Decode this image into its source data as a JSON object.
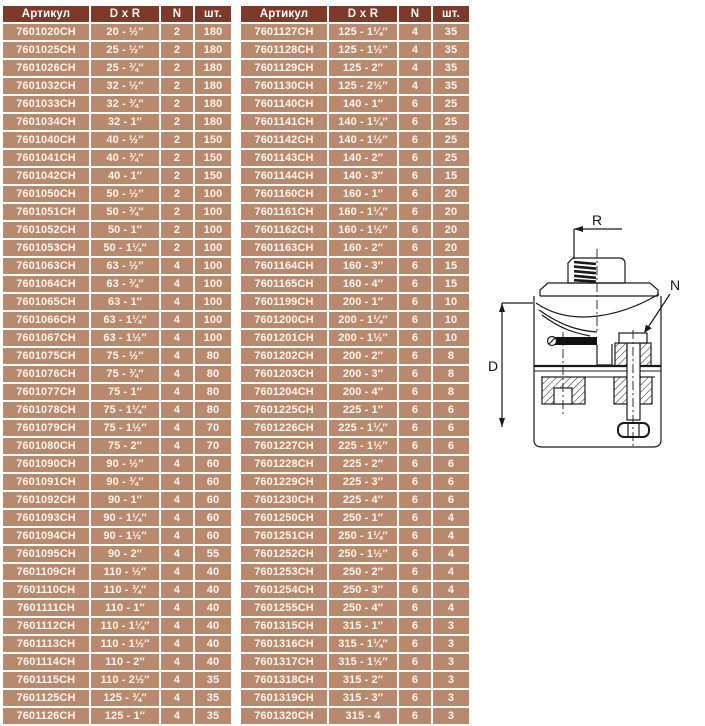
{
  "colors": {
    "header_bg": "#7e3a28",
    "row_bg": "#b9896e",
    "grid": "#ffffff",
    "header_text": "#ffffff",
    "row_text": "#fcf5ee",
    "diagram_line": "#1a1a1a"
  },
  "tables": {
    "headers": [
      "Артикул",
      "D x R",
      "N",
      "шт."
    ],
    "left": {
      "rows": [
        [
          "7601020CH",
          "20 - ½″",
          "2",
          "180"
        ],
        [
          "7601025CH",
          "25 - ½″",
          "2",
          "180"
        ],
        [
          "7601026CH",
          "25 - ¾″",
          "2",
          "180"
        ],
        [
          "7601032CH",
          "32 - ½″",
          "2",
          "180"
        ],
        [
          "7601033CH",
          "32 - ¾″",
          "2",
          "180"
        ],
        [
          "7601034CH",
          "32 - 1″",
          "2",
          "180"
        ],
        [
          "7601040CH",
          "40 - ½″",
          "2",
          "150"
        ],
        [
          "7601041CH",
          "40 - ¾″",
          "2",
          "150"
        ],
        [
          "7601042CH",
          "40 - 1″",
          "2",
          "150"
        ],
        [
          "7601050CH",
          "50 - ½″",
          "2",
          "100"
        ],
        [
          "7601051CH",
          "50 - ¾″",
          "2",
          "100"
        ],
        [
          "7601052CH",
          "50 - 1″",
          "2",
          "100"
        ],
        [
          "7601053CH",
          "50 - 1¼″",
          "2",
          "100"
        ],
        [
          "7601063CH",
          "63 - ½″",
          "4",
          "100"
        ],
        [
          "7601064CH",
          "63 - ¾″",
          "4",
          "100"
        ],
        [
          "7601065CH",
          "63 - 1″",
          "4",
          "100"
        ],
        [
          "7601066CH",
          "63 - 1¼″",
          "4",
          "100"
        ],
        [
          "7601067CH",
          "63 - 1½″",
          "4",
          "100"
        ],
        [
          "7601075CH",
          "75 - ½″",
          "4",
          "80"
        ],
        [
          "7601076CH",
          "75 - ¾″",
          "4",
          "80"
        ],
        [
          "7601077CH",
          "75 - 1″",
          "4",
          "80"
        ],
        [
          "7601078CH",
          "75 - 1¼″",
          "4",
          "80"
        ],
        [
          "7601079CH",
          "75 - 1½″",
          "4",
          "70"
        ],
        [
          "7601080CH",
          "75 - 2″",
          "4",
          "70"
        ],
        [
          "7601090CH",
          "90 - ½″",
          "4",
          "60"
        ],
        [
          "7601091CH",
          "90 - ¾″",
          "4",
          "60"
        ],
        [
          "7601092CH",
          "90 - 1″",
          "4",
          "60"
        ],
        [
          "7601093CH",
          "90 - 1¼″",
          "4",
          "60"
        ],
        [
          "7601094CH",
          "90 - 1½″",
          "4",
          "60"
        ],
        [
          "7601095CH",
          "90 - 2″",
          "4",
          "55"
        ],
        [
          "7601109CH",
          "110 - ½″",
          "4",
          "40"
        ],
        [
          "7601110CH",
          "110 - ¾″",
          "4",
          "40"
        ],
        [
          "7601111CH",
          "110 - 1″",
          "4",
          "40"
        ],
        [
          "7601112CH",
          "110 - 1¼″",
          "4",
          "40"
        ],
        [
          "7601113CH",
          "110 - 1½″",
          "4",
          "40"
        ],
        [
          "7601114CH",
          "110 - 2″",
          "4",
          "40"
        ],
        [
          "7601115CH",
          "110 - 2½″",
          "4",
          "35"
        ],
        [
          "7601125CH",
          "125 - ¾″",
          "4",
          "35"
        ],
        [
          "7601126CH",
          "125 - 1″",
          "4",
          "35"
        ]
      ]
    },
    "right": {
      "rows": [
        [
          "7601127CH",
          "125 - 1¼″",
          "4",
          "35"
        ],
        [
          "7601128CH",
          "125 - 1½″",
          "4",
          "35"
        ],
        [
          "7601129CH",
          "125 - 2″",
          "4",
          "35"
        ],
        [
          "7601130CH",
          "125 - 2½″",
          "4",
          "35"
        ],
        [
          "7601140CH",
          "140 - 1″",
          "6",
          "25"
        ],
        [
          "7601141CH",
          "140 - 1¼″",
          "6",
          "25"
        ],
        [
          "7601142CH",
          "140 - 1½″",
          "6",
          "25"
        ],
        [
          "7601143CH",
          "140 - 2″",
          "6",
          "25"
        ],
        [
          "7601144CH",
          "140 - 3″",
          "6",
          "15"
        ],
        [
          "7601160CH",
          "160 - 1″",
          "6",
          "20"
        ],
        [
          "7601161CH",
          "160 - 1¼″",
          "6",
          "20"
        ],
        [
          "7601162CH",
          "160 - 1½″",
          "6",
          "20"
        ],
        [
          "7601163CH",
          "160 - 2″",
          "6",
          "20"
        ],
        [
          "7601164CH",
          "160 - 3″",
          "6",
          "15"
        ],
        [
          "7601165CH",
          "160 - 4″",
          "6",
          "15"
        ],
        [
          "7601199CH",
          "200 - 1″",
          "6",
          "10"
        ],
        [
          "7601200CH",
          "200 - 1¼″",
          "6",
          "10"
        ],
        [
          "7601201CH",
          "200 - 1½″",
          "6",
          "10"
        ],
        [
          "7601202CH",
          "200 - 2″",
          "6",
          "8"
        ],
        [
          "7601203CH",
          "200 - 3″",
          "6",
          "8"
        ],
        [
          "7601204CH",
          "200 - 4″",
          "6",
          "8"
        ],
        [
          "7601225CH",
          "225 - 1″",
          "6",
          "6"
        ],
        [
          "7601226CH",
          "225 - 1¼″",
          "6",
          "6"
        ],
        [
          "7601227CH",
          "225 - 1½″",
          "6",
          "6"
        ],
        [
          "7601228CH",
          "225 - 2″",
          "6",
          "6"
        ],
        [
          "7601229CH",
          "225 - 3″",
          "6",
          "6"
        ],
        [
          "7601230CH",
          "225 - 4″",
          "6",
          "6"
        ],
        [
          "7601250CH",
          "250 - 1″",
          "6",
          "4"
        ],
        [
          "7601251CH",
          "250 - 1¼″",
          "6",
          "4"
        ],
        [
          "7601252CH",
          "250 - 1½″",
          "6",
          "4"
        ],
        [
          "7601253CH",
          "250 - 2″",
          "6",
          "4"
        ],
        [
          "7601254CH",
          "250 - 3″",
          "6",
          "4"
        ],
        [
          "7601255CH",
          "250 - 4″",
          "6",
          "4"
        ],
        [
          "7601315CH",
          "315 - 1″",
          "6",
          "3"
        ],
        [
          "7601316CH",
          "315 - 1¼″",
          "6",
          "3"
        ],
        [
          "7601317CH",
          "315 - 1½″",
          "6",
          "3"
        ],
        [
          "7601318CH",
          "315 - 2″",
          "6",
          "3"
        ],
        [
          "7601319CH",
          "315 - 3″",
          "6",
          "3"
        ],
        [
          "7601320CH",
          "315 - 4",
          "6",
          "3"
        ]
      ]
    }
  },
  "diagram": {
    "labels": {
      "r": "R",
      "n": "N",
      "d": "D"
    }
  }
}
